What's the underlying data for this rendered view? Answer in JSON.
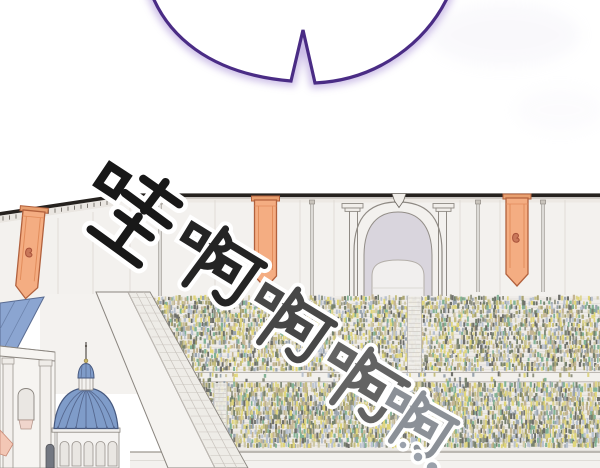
{
  "panel": {
    "alt": "Webtoon panel: empty speech bubble above a roaring colosseum crowd scene",
    "speech_bubble": {
      "text": ""
    },
    "sfx": {
      "text": "哇啊啊啊啊……",
      "characters": [
        {
          "glyph": "哇",
          "color": "#181818"
        },
        {
          "glyph": "啊",
          "color": "#242424"
        },
        {
          "glyph": "啊",
          "color": "#474747"
        },
        {
          "glyph": "啊",
          "color": "#636363"
        },
        {
          "glyph": "啊",
          "color": "#8b9097"
        }
      ],
      "trailing_dots": 3,
      "dot_color": "#9aa1ab"
    },
    "scene": {
      "banners": 3,
      "arch_gates": 1,
      "crowd_tiers": 2
    },
    "colors": {
      "background": "#ffffff",
      "bubble_outline": "#4a2c85",
      "bubble_glow": "#a78fd6",
      "roofline": "#26221f",
      "wall": "#f3f1ee",
      "wall_seam": "#ddd8d2",
      "banner_fill": "#f4ad82",
      "banner_border": "#b2613d",
      "banner_stripe": "#e28d5c",
      "arch_shadow": "#d9d5dd",
      "tunnel": "#f1efee",
      "stand_bg": "#efece8",
      "row_line": "#d7d3cd",
      "dome_blue": "#7f9cc9",
      "dome_rib": "#56688f",
      "roof_blue": "#8ba5d1",
      "pink_roof": "#f3c7b5",
      "crowd_palette": [
        "#a9a472",
        "#c4bd7e",
        "#ddd48a",
        "#8f9180",
        "#9aa4ae",
        "#83b295",
        "#c3b493",
        "#77826e",
        "#b9c2cf",
        "#6e6f6a",
        "#e0d67a",
        "#cfc9a8"
      ]
    }
  }
}
